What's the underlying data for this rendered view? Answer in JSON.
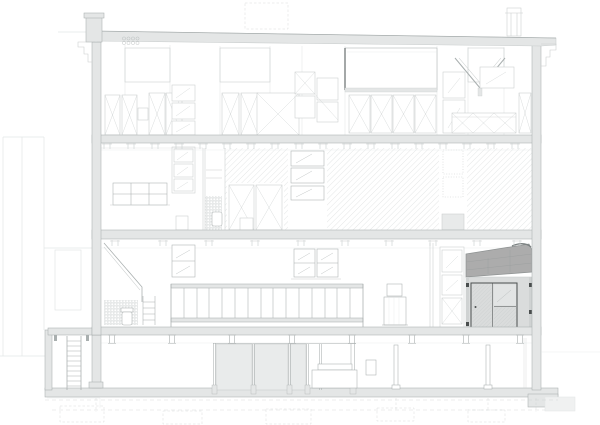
{
  "meta": {
    "kind": "architectural-building-section-drawing",
    "sheet_background": "#ffffff",
    "levels_visible": 4,
    "has_basement": true
  },
  "palette": {
    "sheet": "#ffffff",
    "white": "#ffffff",
    "line-faint": "#e3e6e6",
    "line-light": "#c9cdcd",
    "line-mid": "#a9afaf",
    "line-dark": "#7d8383",
    "slab-fill": "#e4e6e6",
    "glass-fill": "#e9ebeb",
    "annex-roof": "#acacac",
    "annex-roof-edge": "#8f9393",
    "annex-wall": "#dadcdc",
    "frame-dark": "#4a4e4e",
    "hatch-line": "#d8dcdc",
    "hatch-fine": "#c4c8c8",
    "tile-line": "#c8cccc"
  },
  "inventory": [
    "adjacent-building-outline",
    "roof-slab",
    "chimney-left",
    "chimney-right",
    "vent-detail",
    "attic-skylight",
    "extract-hood",
    "attic-storage-cabinets",
    "floor-slab-attic",
    "floor-slab-second",
    "floor-slab-first",
    "ground-slab",
    "hatched-partition-walls",
    "casement-windows",
    "six-pane-window",
    "toilet-room",
    "tiled-wall",
    "toilet",
    "step-stool",
    "sloped-stair-wall",
    "balustrade",
    "stove",
    "wardrobe-column",
    "annex-mono-pitch-roof",
    "annex-glazed-door",
    "glazed-shopfront",
    "counter",
    "ladder",
    "columns",
    "foundation-footings",
    "grade-line"
  ]
}
